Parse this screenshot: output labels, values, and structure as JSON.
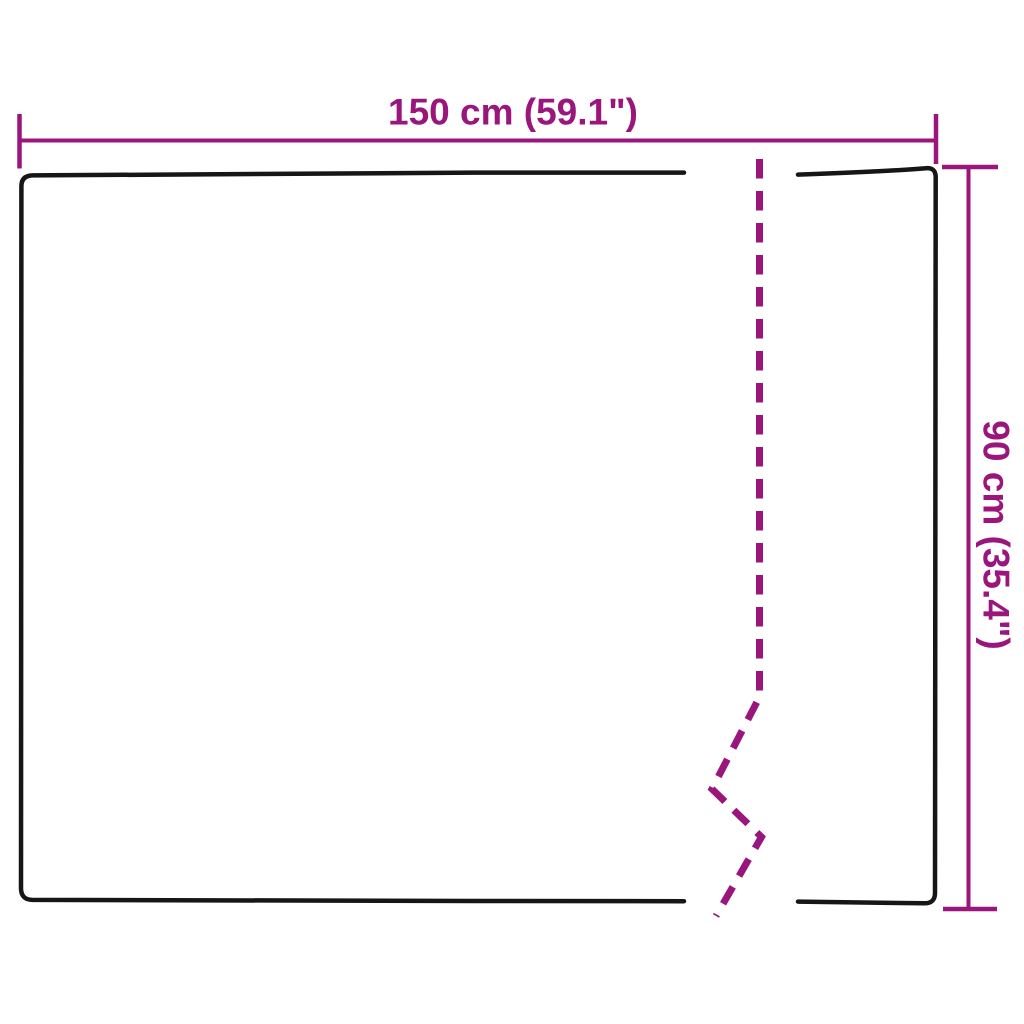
{
  "colors": {
    "background": "#ffffff",
    "outline": "#161616",
    "dimension": "#9a157c"
  },
  "diagram": {
    "type": "product-dimension-diagram",
    "width_label": "150 cm (59.1\")",
    "height_label": "90 cm (35.4\")",
    "width_cm": "150",
    "width_inches": "59.1",
    "height_cm": "90",
    "height_inches": "35.4"
  }
}
